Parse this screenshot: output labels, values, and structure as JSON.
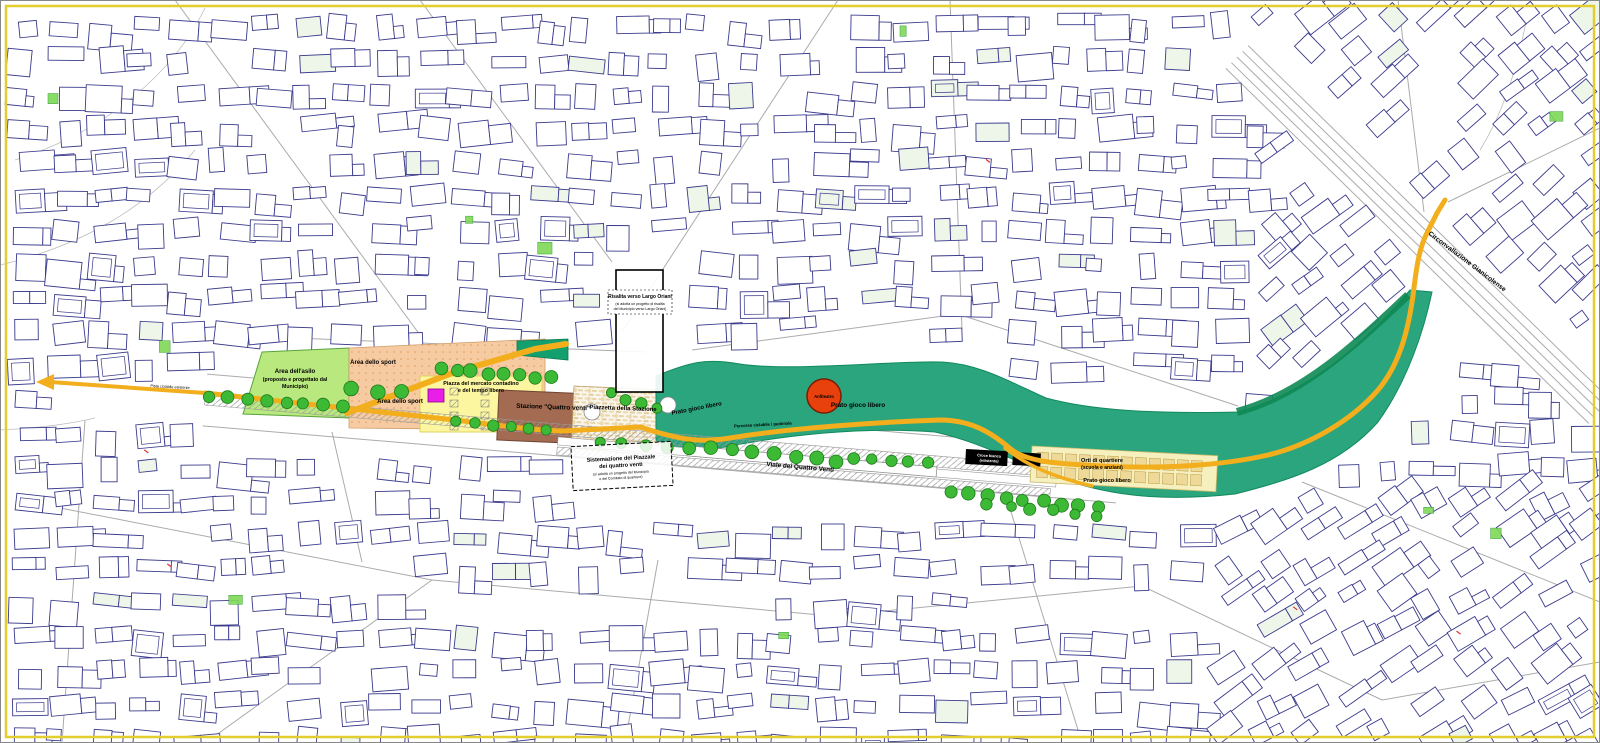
{
  "map": {
    "type": "urban-masterplan",
    "labels": {
      "asilo_1": "Area dell'asilo",
      "asilo_2": "(proposto e progettato dal",
      "asilo_3": "Municipio)",
      "sport_top": "Area dello sport",
      "sport_bottom": "Area dello sport",
      "mercato_1": "Piazza del mercato contadino",
      "mercato_2": "e del tempo libero",
      "stazione": "Stazione \"Quattro venti\"",
      "piazzetta": "Piazzetta della Stazione",
      "risalita_1": "Risalita verso Largo Oriani",
      "risalita_2": "(si adotta un progetto di risalita",
      "risalita_3": "del Municipio verso Largo Oriani)",
      "prato_1": "Prato gioco libero",
      "anfiteatro": "Anfiteatro",
      "prato_2": "Prato gioco libero",
      "percorso": "Percorso ciclabile / pedonale",
      "viale": "Viale dei Quattro Venti",
      "croce_1": "Croce bianca",
      "croce_2": "(esistente)",
      "orti_1": "Orti di quartiere",
      "orti_2": "(scuola e anziani)",
      "prato_3": "Prato gioco libero",
      "circonvallazione": "Circonvallazione Gianicolense",
      "piazzale_1": "Sistemazione del Piazzale",
      "piazzale_2": "dei quattro venti",
      "piazzale_3": "(si adotta un progetto del Municipio",
      "piazzale_4": "e del Comitato di quartiere)",
      "pista": "Pista ciclabile esistente"
    },
    "colors": {
      "frame": "#e2ce2e",
      "park": "#2ba57d",
      "parkStroke": "#128a5c",
      "parkDark": "#0e8a55",
      "lawn": "#b9e97e",
      "lawnStroke": "#57a33b",
      "sport": "#f6cba2",
      "market": "#fcf6a0",
      "station": "#a26b52",
      "plaza": "#ecd9ae",
      "tree": "#3cba35",
      "treeStroke": "#1d7a1a",
      "path": "#f2ae1c",
      "anfiteatro": "#e8410e",
      "magenta": "#e91fe9",
      "building": "#3a3a8c",
      "street": "#ababab",
      "orti": "#f6efbe",
      "ortiPlot": "#eed998"
    }
  }
}
